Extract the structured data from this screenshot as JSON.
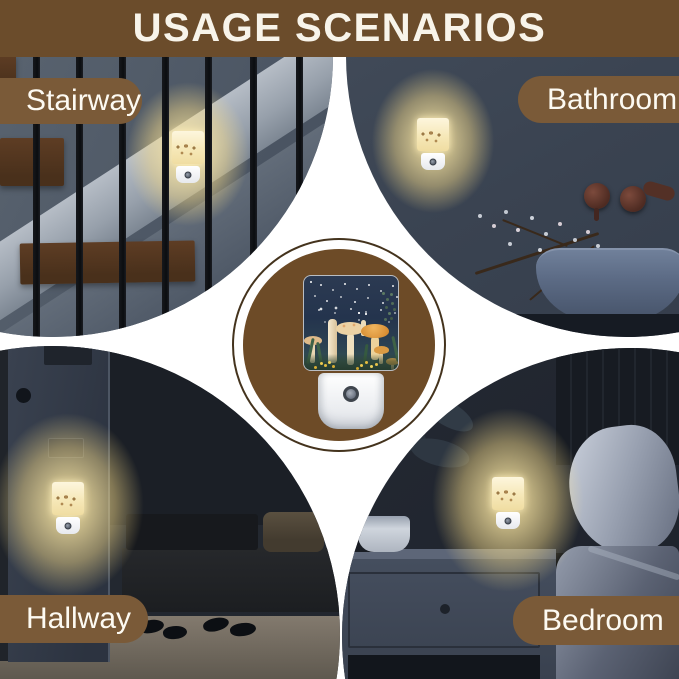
{
  "title": "USAGE SCENARIOS",
  "scenes": [
    {
      "id": "stairway",
      "label": "Stairway"
    },
    {
      "id": "bathroom",
      "label": "Bathroom"
    },
    {
      "id": "hallway",
      "label": "Hallway"
    },
    {
      "id": "bedroom",
      "label": "Bedroom"
    }
  ],
  "colors": {
    "header_brown": "#6b4c2b",
    "pill_brown": "#7a5a38",
    "medallion_brown": "#6d4b27",
    "medallion_outline": "#44331d",
    "canvas_white": "#ffffff",
    "title_text": "#f8f4ea",
    "pill_text": "#fdfaf2",
    "glow_warm": "#ffe8a5",
    "night_slate": "#3c4656"
  }
}
